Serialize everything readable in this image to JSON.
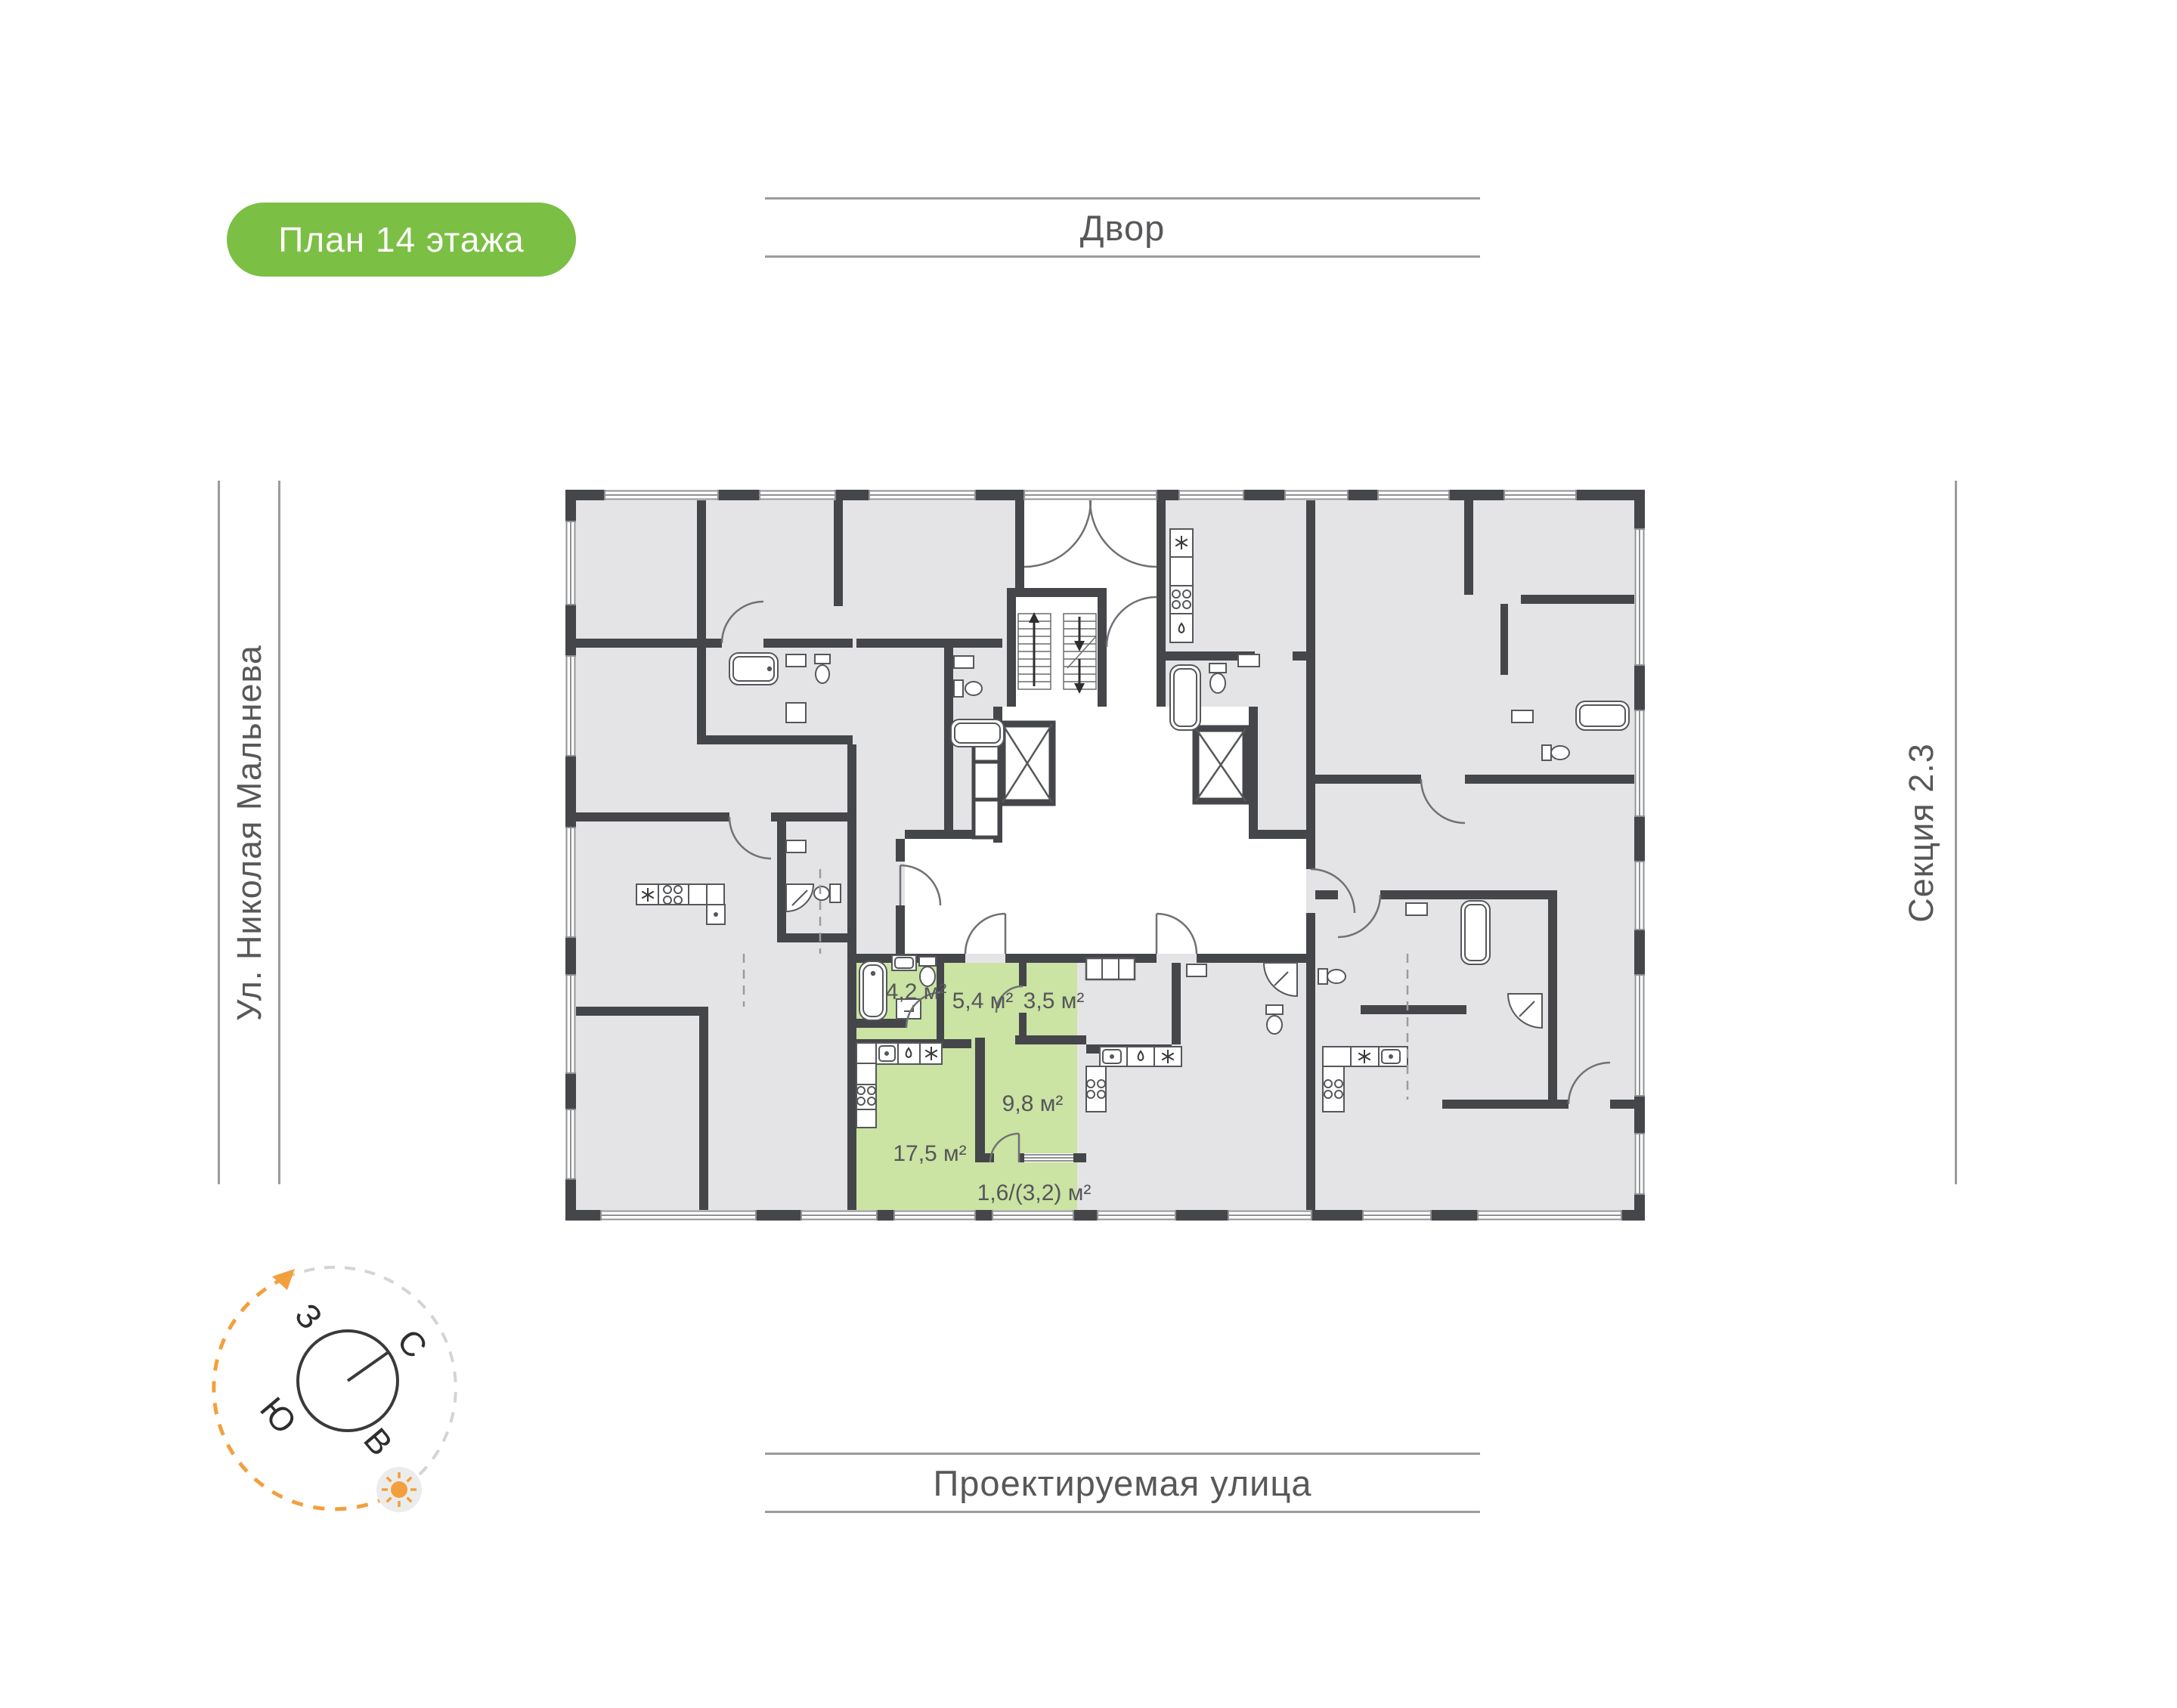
{
  "page": {
    "badge": "План 14 этажа"
  },
  "surroundings": {
    "top": "Двор",
    "bottom": "Проектируемая улица",
    "left": "Ул. Николая Мальнева",
    "right": "Секция 2.3"
  },
  "compass": {
    "north": "С",
    "south": "Ю",
    "west": "З",
    "east": "В"
  },
  "apartment": {
    "rooms": [
      {
        "name": "bathroom",
        "area": "4,2 м²"
      },
      {
        "name": "hallway",
        "area": "5,4 м²"
      },
      {
        "name": "wardrobe",
        "area": "3,5 м²"
      },
      {
        "name": "bedroom",
        "area": "9,8 м²"
      },
      {
        "name": "living-kitchen",
        "area": "17,5 м²"
      },
      {
        "name": "balcony",
        "area": "1,6/(3,2) м²"
      }
    ]
  },
  "colors": {
    "accent_green": "#7bbf44",
    "highlight_green": "#cbe3a3",
    "wall": "#44464a",
    "apartment_fill": "#e4e4e6",
    "header_line": "#9b9b9b",
    "compass_orange": "#f2a03d"
  }
}
